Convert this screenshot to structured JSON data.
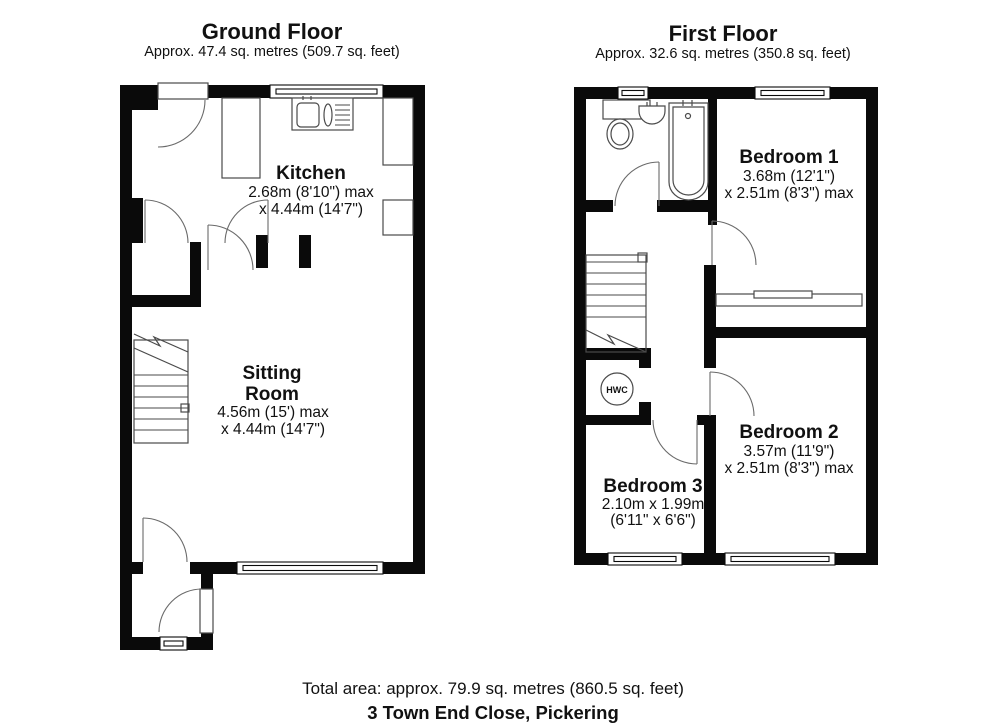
{
  "ground_floor": {
    "title": "Ground Floor",
    "area": "Approx. 47.4 sq. metres (509.7 sq. feet)",
    "rooms": {
      "kitchen": {
        "name": "Kitchen",
        "dim1": "2.68m (8'10\") max",
        "dim2": "x 4.44m (14'7\")"
      },
      "sitting_room": {
        "name_line1": "Sitting",
        "name_line2": "Room",
        "dim1": "4.56m (15') max",
        "dim2": "x 4.44m (14'7\")"
      }
    }
  },
  "first_floor": {
    "title": "First Floor",
    "area": "Approx. 32.6 sq. metres (350.8 sq. feet)",
    "rooms": {
      "bedroom1": {
        "name": "Bedroom 1",
        "dim1": "3.68m (12'1\")",
        "dim2": "x 2.51m (8'3\") max"
      },
      "bedroom2": {
        "name": "Bedroom 2",
        "dim1": "3.57m (11'9\")",
        "dim2": "x 2.51m (8'3\") max"
      },
      "bedroom3": {
        "name": "Bedroom 3",
        "dim1": "2.10m x 1.99m",
        "dim2": "(6'11\" x 6'6\")"
      },
      "hwc": {
        "label": "HWC"
      }
    }
  },
  "footer": {
    "total_area": "Total area: approx. 79.9 sq. metres (860.5 sq. feet)",
    "address": "3 Town End Close, Pickering"
  },
  "colors": {
    "wall": "#0a0a0a",
    "fixture_line": "#4a4a4a",
    "background": "#ffffff"
  }
}
